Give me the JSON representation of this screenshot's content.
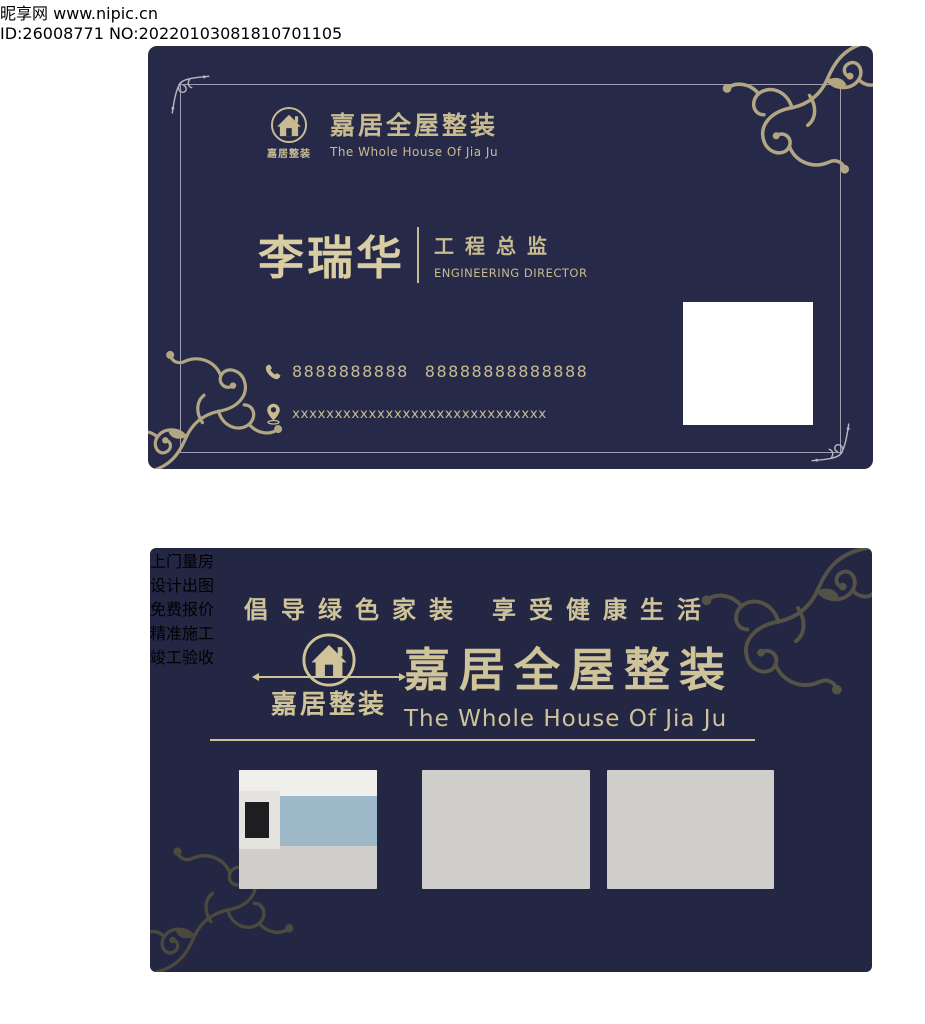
{
  "front_card": {
    "brand": {
      "logo_text": "嘉居整装",
      "title": "嘉居全屋整装",
      "subtitle": "The Whole House Of Jia Ju"
    },
    "person": {
      "name": "李瑞华",
      "title_cn": "工程总监",
      "title_en": "ENGINEERING DIRECTOR"
    },
    "contact": {
      "phone1": "8888888888",
      "phone2": "88888888888888",
      "address": "xxxxxxxxxxxxxxxxxxxxxxxxxxxxxx"
    }
  },
  "back_card": {
    "slogan_left": "倡导绿色家装",
    "slogan_right": "享受健康生活",
    "brand": {
      "logo_text": "嘉居整装",
      "title": "嘉居全屋整装",
      "subtitle": "The Whole House Of Jia Ju"
    },
    "steps": [
      "上门量房",
      "设计出图",
      "免费报价",
      "精准施工",
      "竣工验收"
    ]
  },
  "watermark": {
    "site_name": "昵享网",
    "site_url": "www.nipic.cn",
    "id_text": "ID:26008771 NO:20220103081810701105"
  },
  "colors": {
    "card_navy_front": "#262a48",
    "card_navy_back": "#232744",
    "gold": "#c8bb91",
    "gold_light": "#d9cda3",
    "flourish_gold": "#b3a682",
    "flourish_olive": "#5a5847"
  }
}
